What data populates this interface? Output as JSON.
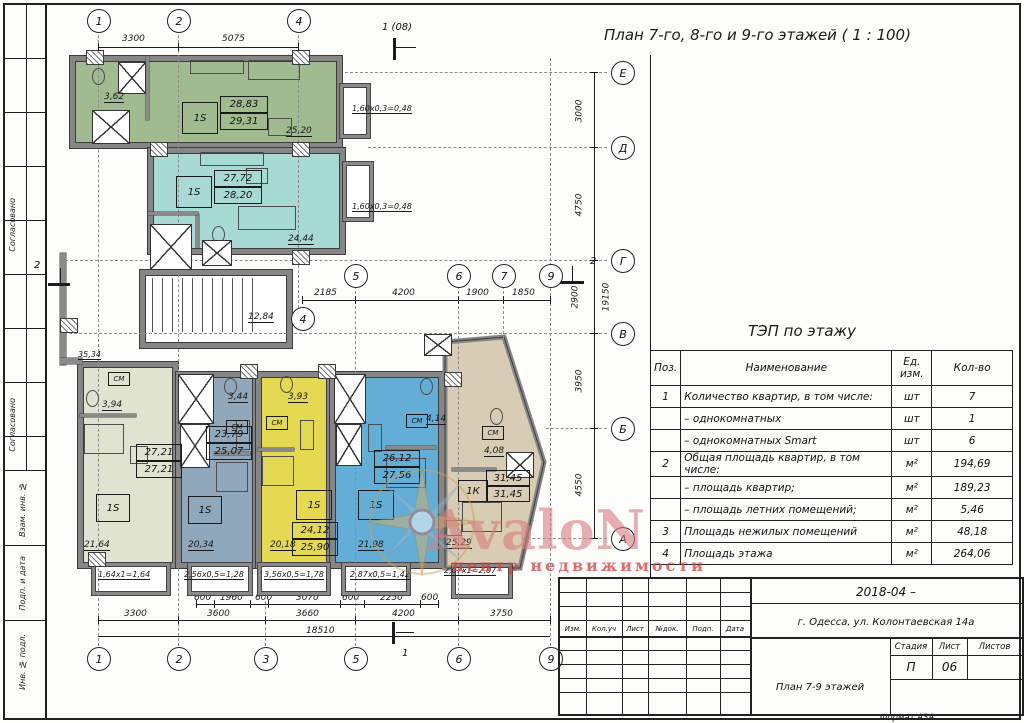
{
  "title": "План 7-го, 8-го и 9-го этажей ( 1 : 100)",
  "format_note": "Формат А3А",
  "left_margin": {
    "soglasovano1": "Согласовано",
    "soglasovano2": "Согласовано",
    "vzam": "Взам. инв. №",
    "podp": "Подп. и дата",
    "inv": "Инв. № подл."
  },
  "watermark": {
    "brand": "AvaloN",
    "subtitle": "центр недвижимости"
  },
  "plan": {
    "axes": {
      "a1": "1",
      "a2": "2",
      "a3": "3",
      "a4": "4",
      "a5": "5",
      "a6": "6",
      "a7": "7",
      "a9": "9",
      "ae": "Е",
      "ad": "Д",
      "ag": "Г",
      "av": "В",
      "ab": "Б",
      "aa": "А"
    },
    "markers": {
      "top": "1 (08)",
      "left": "2",
      "right": "2",
      "bottom": "1"
    },
    "dims": {
      "top1": "3300",
      "top2": "5075",
      "mid1": "2185",
      "mid2": "4200",
      "mid3": "1900",
      "mid4": "1850",
      "b1": "600",
      "b2": "1960",
      "b3": "600",
      "b4": "3070",
      "b5": "600",
      "b6": "2250",
      "b7": "600",
      "r1": "3300",
      "r2": "3600",
      "r3": "3660",
      "r4": "4200",
      "r5": "3750",
      "total": "18510",
      "v1": "3000",
      "v2": "4750",
      "v3": "2900",
      "v4": "3950",
      "v5": "4550",
      "vtotal": "19150"
    },
    "apartments": [
      {
        "type": "1S",
        "a1": "28,83",
        "a2": "29,31"
      },
      {
        "type": "1S",
        "a1": "27,72",
        "a2": "28,20"
      },
      {
        "type": "1S",
        "a1": "27,21",
        "a2": "27,21"
      },
      {
        "type": "1S",
        "a1": "23,79",
        "a2": "25,07"
      },
      {
        "type": "1S",
        "a1": "24,12",
        "a2": "25,90"
      },
      {
        "type": "1S",
        "a1": "26,12",
        "a2": "27,56"
      },
      {
        "type": "1К",
        "a1": "31,45",
        "a2": "31,45"
      }
    ],
    "rooms": {
      "green_wc": "3,62",
      "green_liv": "25,20",
      "teal_liv": "24,44",
      "stairs": "12,84",
      "olive_top": "35,34",
      "olive_wc": "3,94",
      "olive_liv": "21,64",
      "bg_wc": "3,44",
      "bg_liv": "20,34",
      "y_wc": "3,93",
      "y_liv": "20,18",
      "bl_wc": "4,14",
      "bl_liv": "21,98",
      "tan_wc": "4,08",
      "tan_liv": "25,29"
    },
    "notes": {
      "n1": "1,60х0,3=0,48",
      "n2": "1,60х0,3=0,48",
      "n3": "1,64х1=1,64",
      "n4": "2,56х0,5=1,28",
      "n5": "3,56х0,5=1,78",
      "n6": "2,87х0,5=1,42",
      "n7": "2,07х1=2,07"
    },
    "cm": "СМ"
  },
  "tep": {
    "title": "ТЭП по этажу",
    "h_pos": "Поз.",
    "h_name": "Наименование",
    "h_unit": "Ед.\nизм.",
    "h_qty": "Кол-во",
    "rows": [
      {
        "pos": "1",
        "name": "Количество квартир, в том числе:",
        "unit": "шт",
        "qty": "7"
      },
      {
        "pos": "",
        "name": "–  однокомнатных",
        "unit": "шт",
        "qty": "1"
      },
      {
        "pos": "",
        "name": "–  однокомнатных Smart",
        "unit": "шт",
        "qty": "6"
      },
      {
        "pos": "2",
        "name": "Общая площадь квартир, в том числе:",
        "unit": "м²",
        "qty": "194,69"
      },
      {
        "pos": "",
        "name": "–  площадь квартир;",
        "unit": "м²",
        "qty": "189,23"
      },
      {
        "pos": "",
        "name": "–  площадь летних помещений;",
        "unit": "м²",
        "qty": "5,46"
      },
      {
        "pos": "3",
        "name": "Площадь нежилых помещений",
        "unit": "м²",
        "qty": "48,18"
      },
      {
        "pos": "4",
        "name": "Площадь этажа",
        "unit": "м²",
        "qty": "264,06"
      }
    ]
  },
  "titleblock": {
    "doc": "2018-04  –",
    "address": "г. Одесса, ул. Колонтаевская 14а",
    "stage_h": "Стадия",
    "sheet_h": "Лист",
    "sheets_h": "Листов",
    "stage": "П",
    "sheet": "06",
    "sheets": "",
    "name": "План 7-9 этажей",
    "cols": [
      "Изм.",
      "Кол.уч",
      "Лист",
      "№док.",
      "Подп.",
      "Дата"
    ]
  }
}
